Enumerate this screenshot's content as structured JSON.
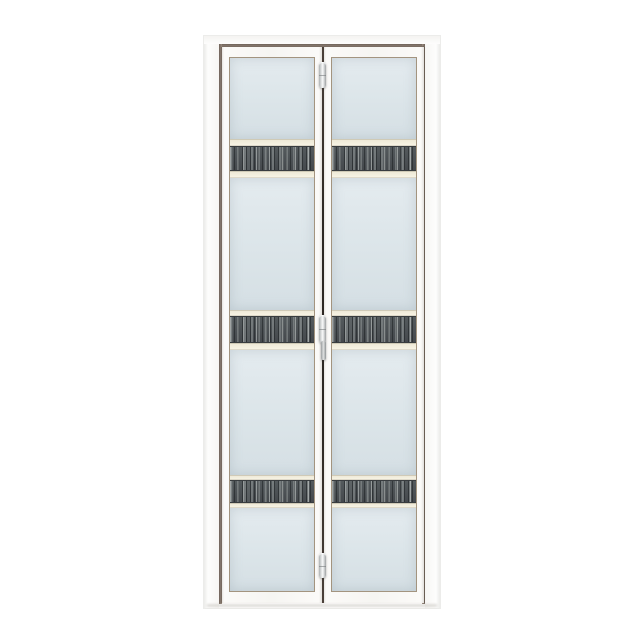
{
  "scene": {
    "type": "product-photo",
    "subject": "white aluminium bi-fold door with frosted glass panels and dark wood-grain accent strips",
    "background_color": "#ffffff"
  },
  "door": {
    "leaf_count": 2,
    "glass_panes_per_leaf": 4,
    "accent_strips_per_leaf": 3,
    "hinges_on_fold_line": 3,
    "has_center_handle": true,
    "colors": {
      "frame_white": "#fdfdfc",
      "frame_reveal_taupe": "#8a7c70",
      "leaf_white": "#f8f7f4",
      "glass_frosted_blue": "#dde6ea",
      "glass_border_taupe": "#a3947f",
      "accent_strip_base": "#4a5054",
      "accent_strip_streak_light": "#b4b9b8",
      "accent_strip_streak_dark": "#2e3336",
      "rail_cream": "#f3efde",
      "hinge_metal": "#dfe1e1",
      "fold_line_dark": "#2e2924"
    }
  }
}
